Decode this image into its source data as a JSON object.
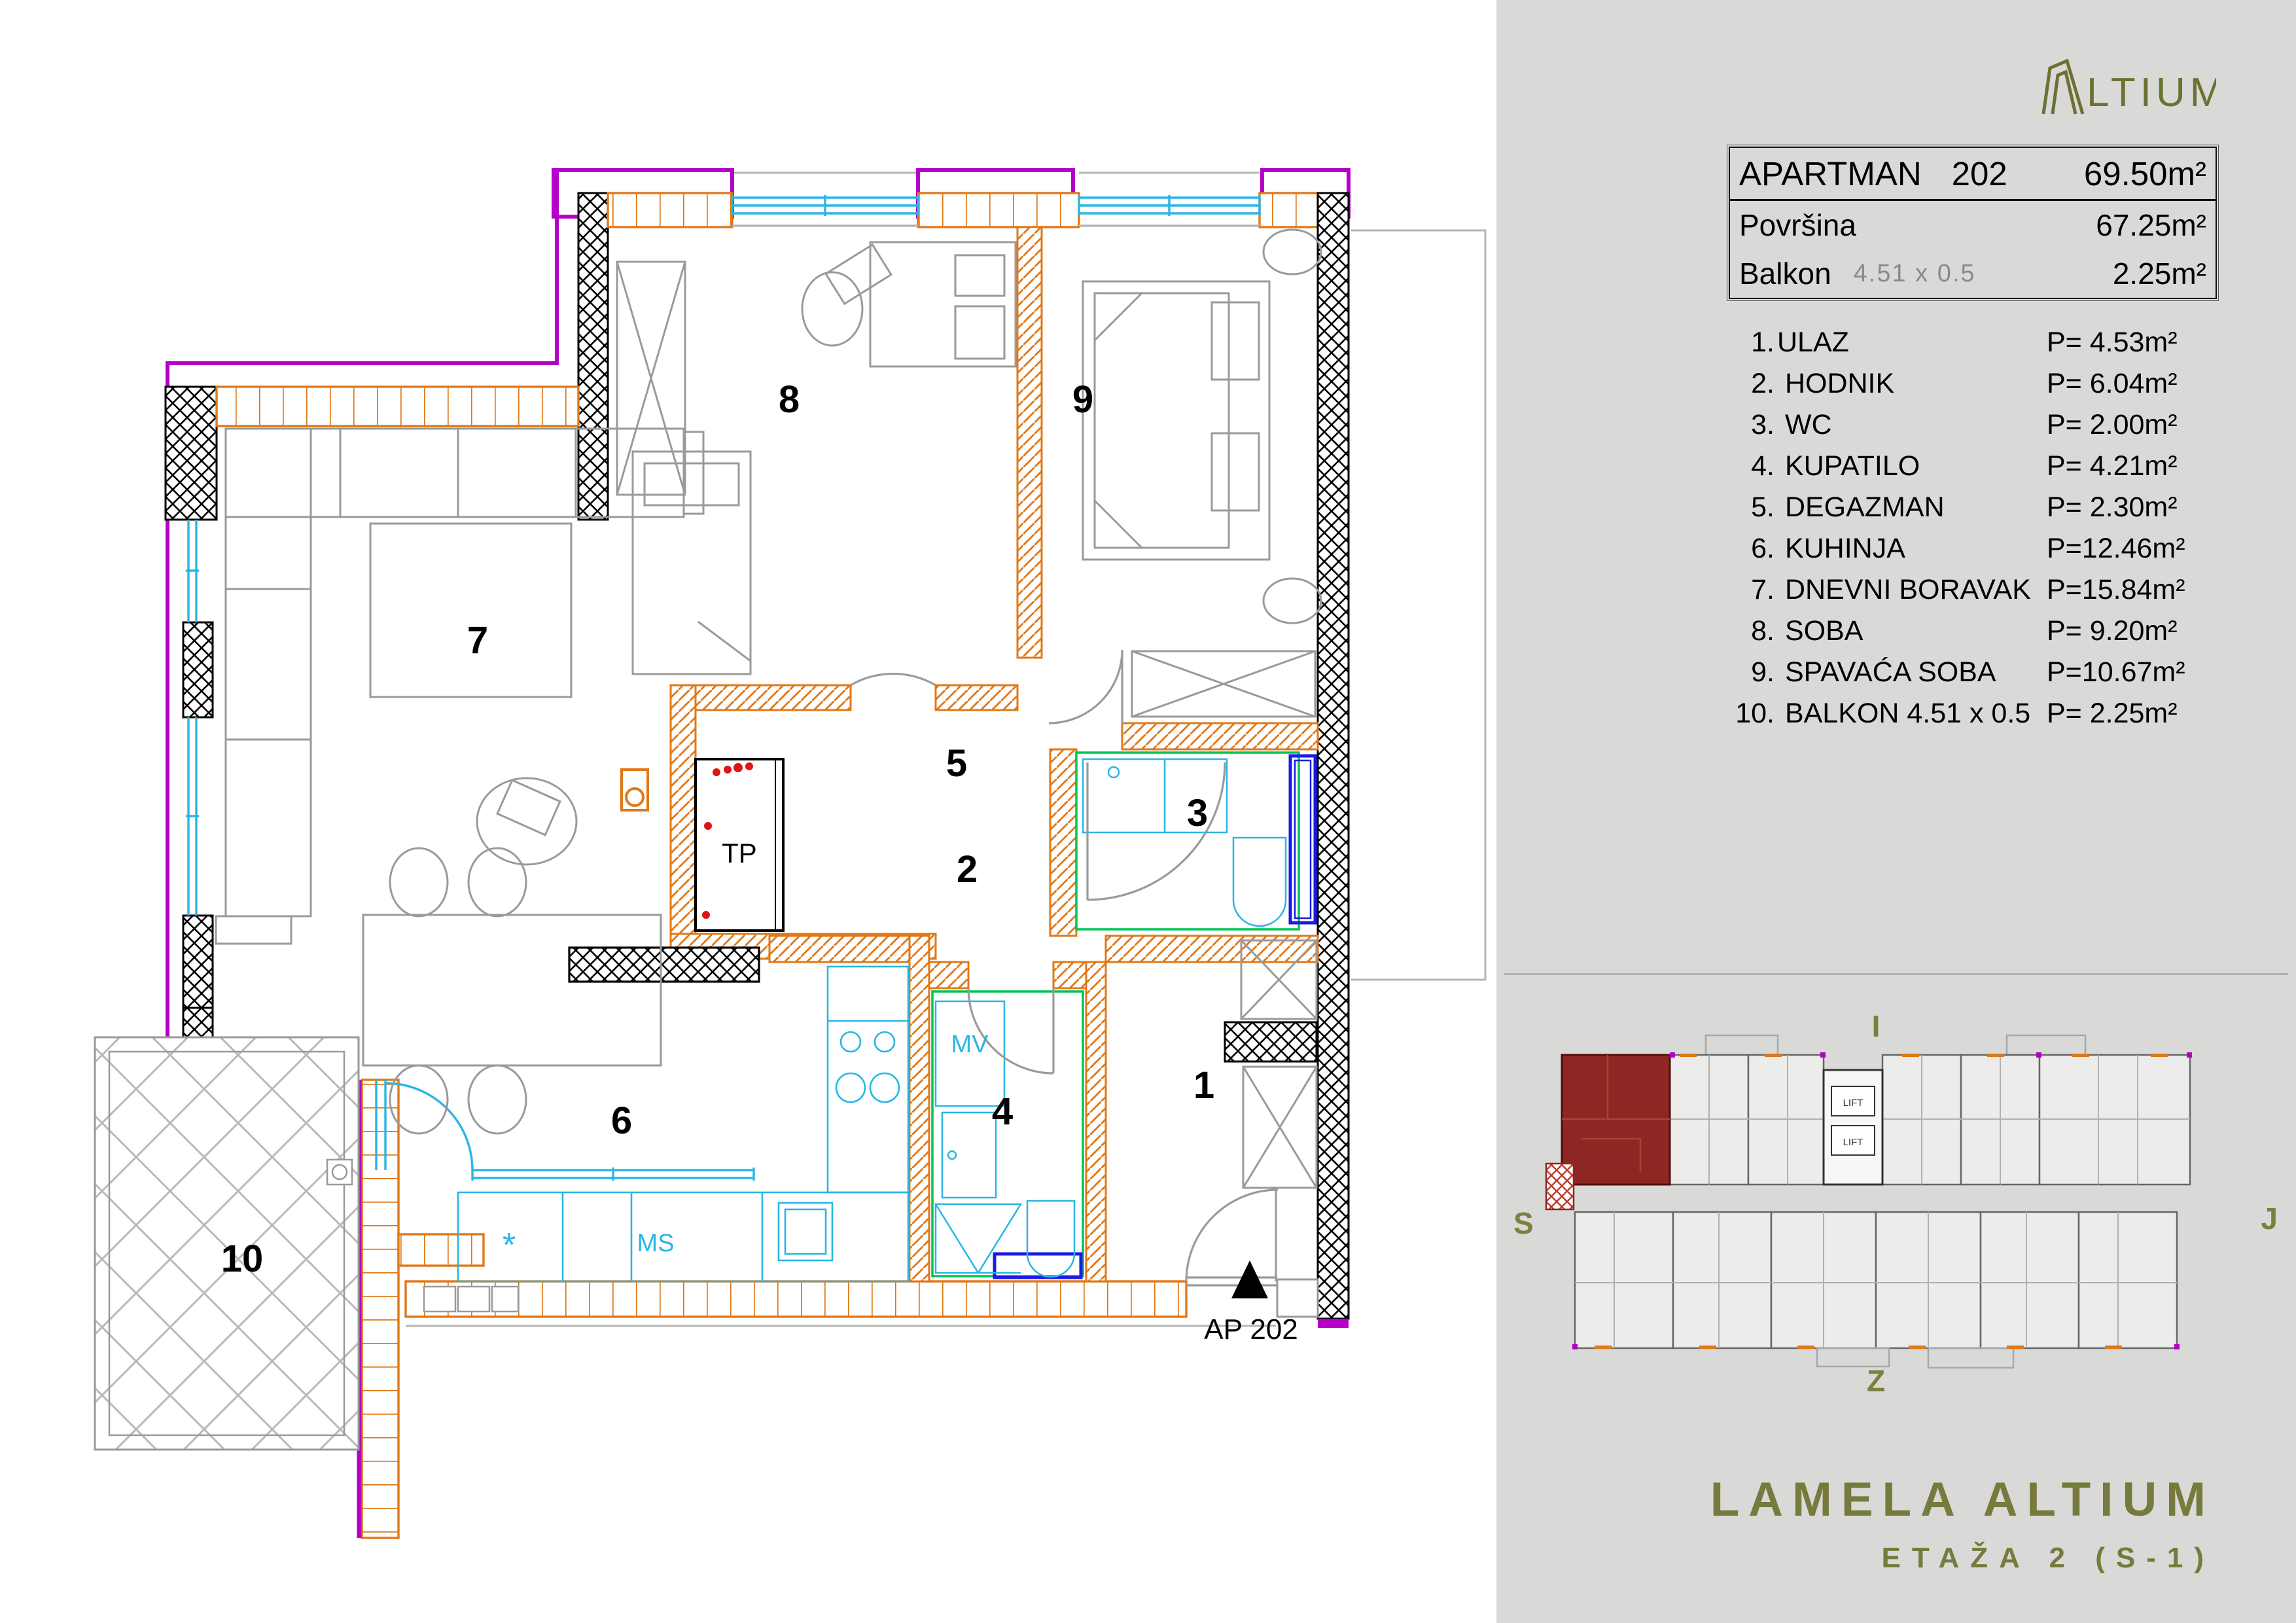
{
  "colors": {
    "sidebar_bg": "#d9d9d7",
    "wall_orange": "#e07818",
    "glass_cyan": "#2ab5e5",
    "boundary_purple": "#b400c8",
    "bath_green": "#00c455",
    "tub_blue": "#1a1ae6",
    "alert_red": "#e01414",
    "target_red": "#8e2723",
    "furniture_gray": "#9a9a9a",
    "olive_logo": "#6e7031",
    "olive_brand": "#767a3c"
  },
  "sidebar": {
    "logo": {
      "text": "LTIUM"
    },
    "info_table": {
      "title_label": "APARTMAN",
      "title_number": "202",
      "title_area": "69.50m²",
      "rows": [
        {
          "label": "Površina",
          "dim": "",
          "value": "67.25m²"
        },
        {
          "label": "Balkon",
          "dim": "4.51 x 0.5",
          "value": "2.25m²"
        }
      ]
    },
    "rooms": [
      {
        "num": "1.",
        "name": "ULAZ",
        "area": "P= 4.53m²"
      },
      {
        "num": "2.",
        "name": " HODNIK",
        "area": "P= 6.04m²"
      },
      {
        "num": "3.",
        "name": " WC",
        "area": "P= 2.00m²"
      },
      {
        "num": "4.",
        "name": " KUPATILO",
        "area": "P= 4.21m²"
      },
      {
        "num": "5.",
        "name": " DEGAZMAN",
        "area": "P= 2.30m²"
      },
      {
        "num": "6.",
        "name": " KUHINJA",
        "area": "P=12.46m²"
      },
      {
        "num": "7.",
        "name": " DNEVNI BORAVAK",
        "area": "P=15.84m²"
      },
      {
        "num": "8.",
        "name": " SOBA",
        "area": "P= 9.20m²"
      },
      {
        "num": "9.",
        "name": " SPAVAĆA SOBA",
        "area": "P=10.67m²"
      },
      {
        "num": "10.",
        "name": " BALKON 4.51 x 0.5",
        "area": "P= 2.25m²"
      }
    ],
    "compass": {
      "top": "I",
      "left": "S",
      "right": "J",
      "bottom": "Z"
    },
    "minimap": {
      "lift": "LIFT"
    },
    "brand": "LAMELA ALTIUM",
    "floor": "ETAŽA 2 (S-1)"
  },
  "plan": {
    "labels": [
      {
        "text": "1"
      },
      {
        "text": "2"
      },
      {
        "text": "3"
      },
      {
        "text": "4"
      },
      {
        "text": "5"
      },
      {
        "text": "6"
      },
      {
        "text": "7"
      },
      {
        "text": "8"
      },
      {
        "text": "9"
      },
      {
        "text": "10"
      }
    ],
    "annotations": {
      "tp": "TP",
      "mv": "MV",
      "ms": "MS",
      "star": "*",
      "marker": "AP 202"
    }
  }
}
